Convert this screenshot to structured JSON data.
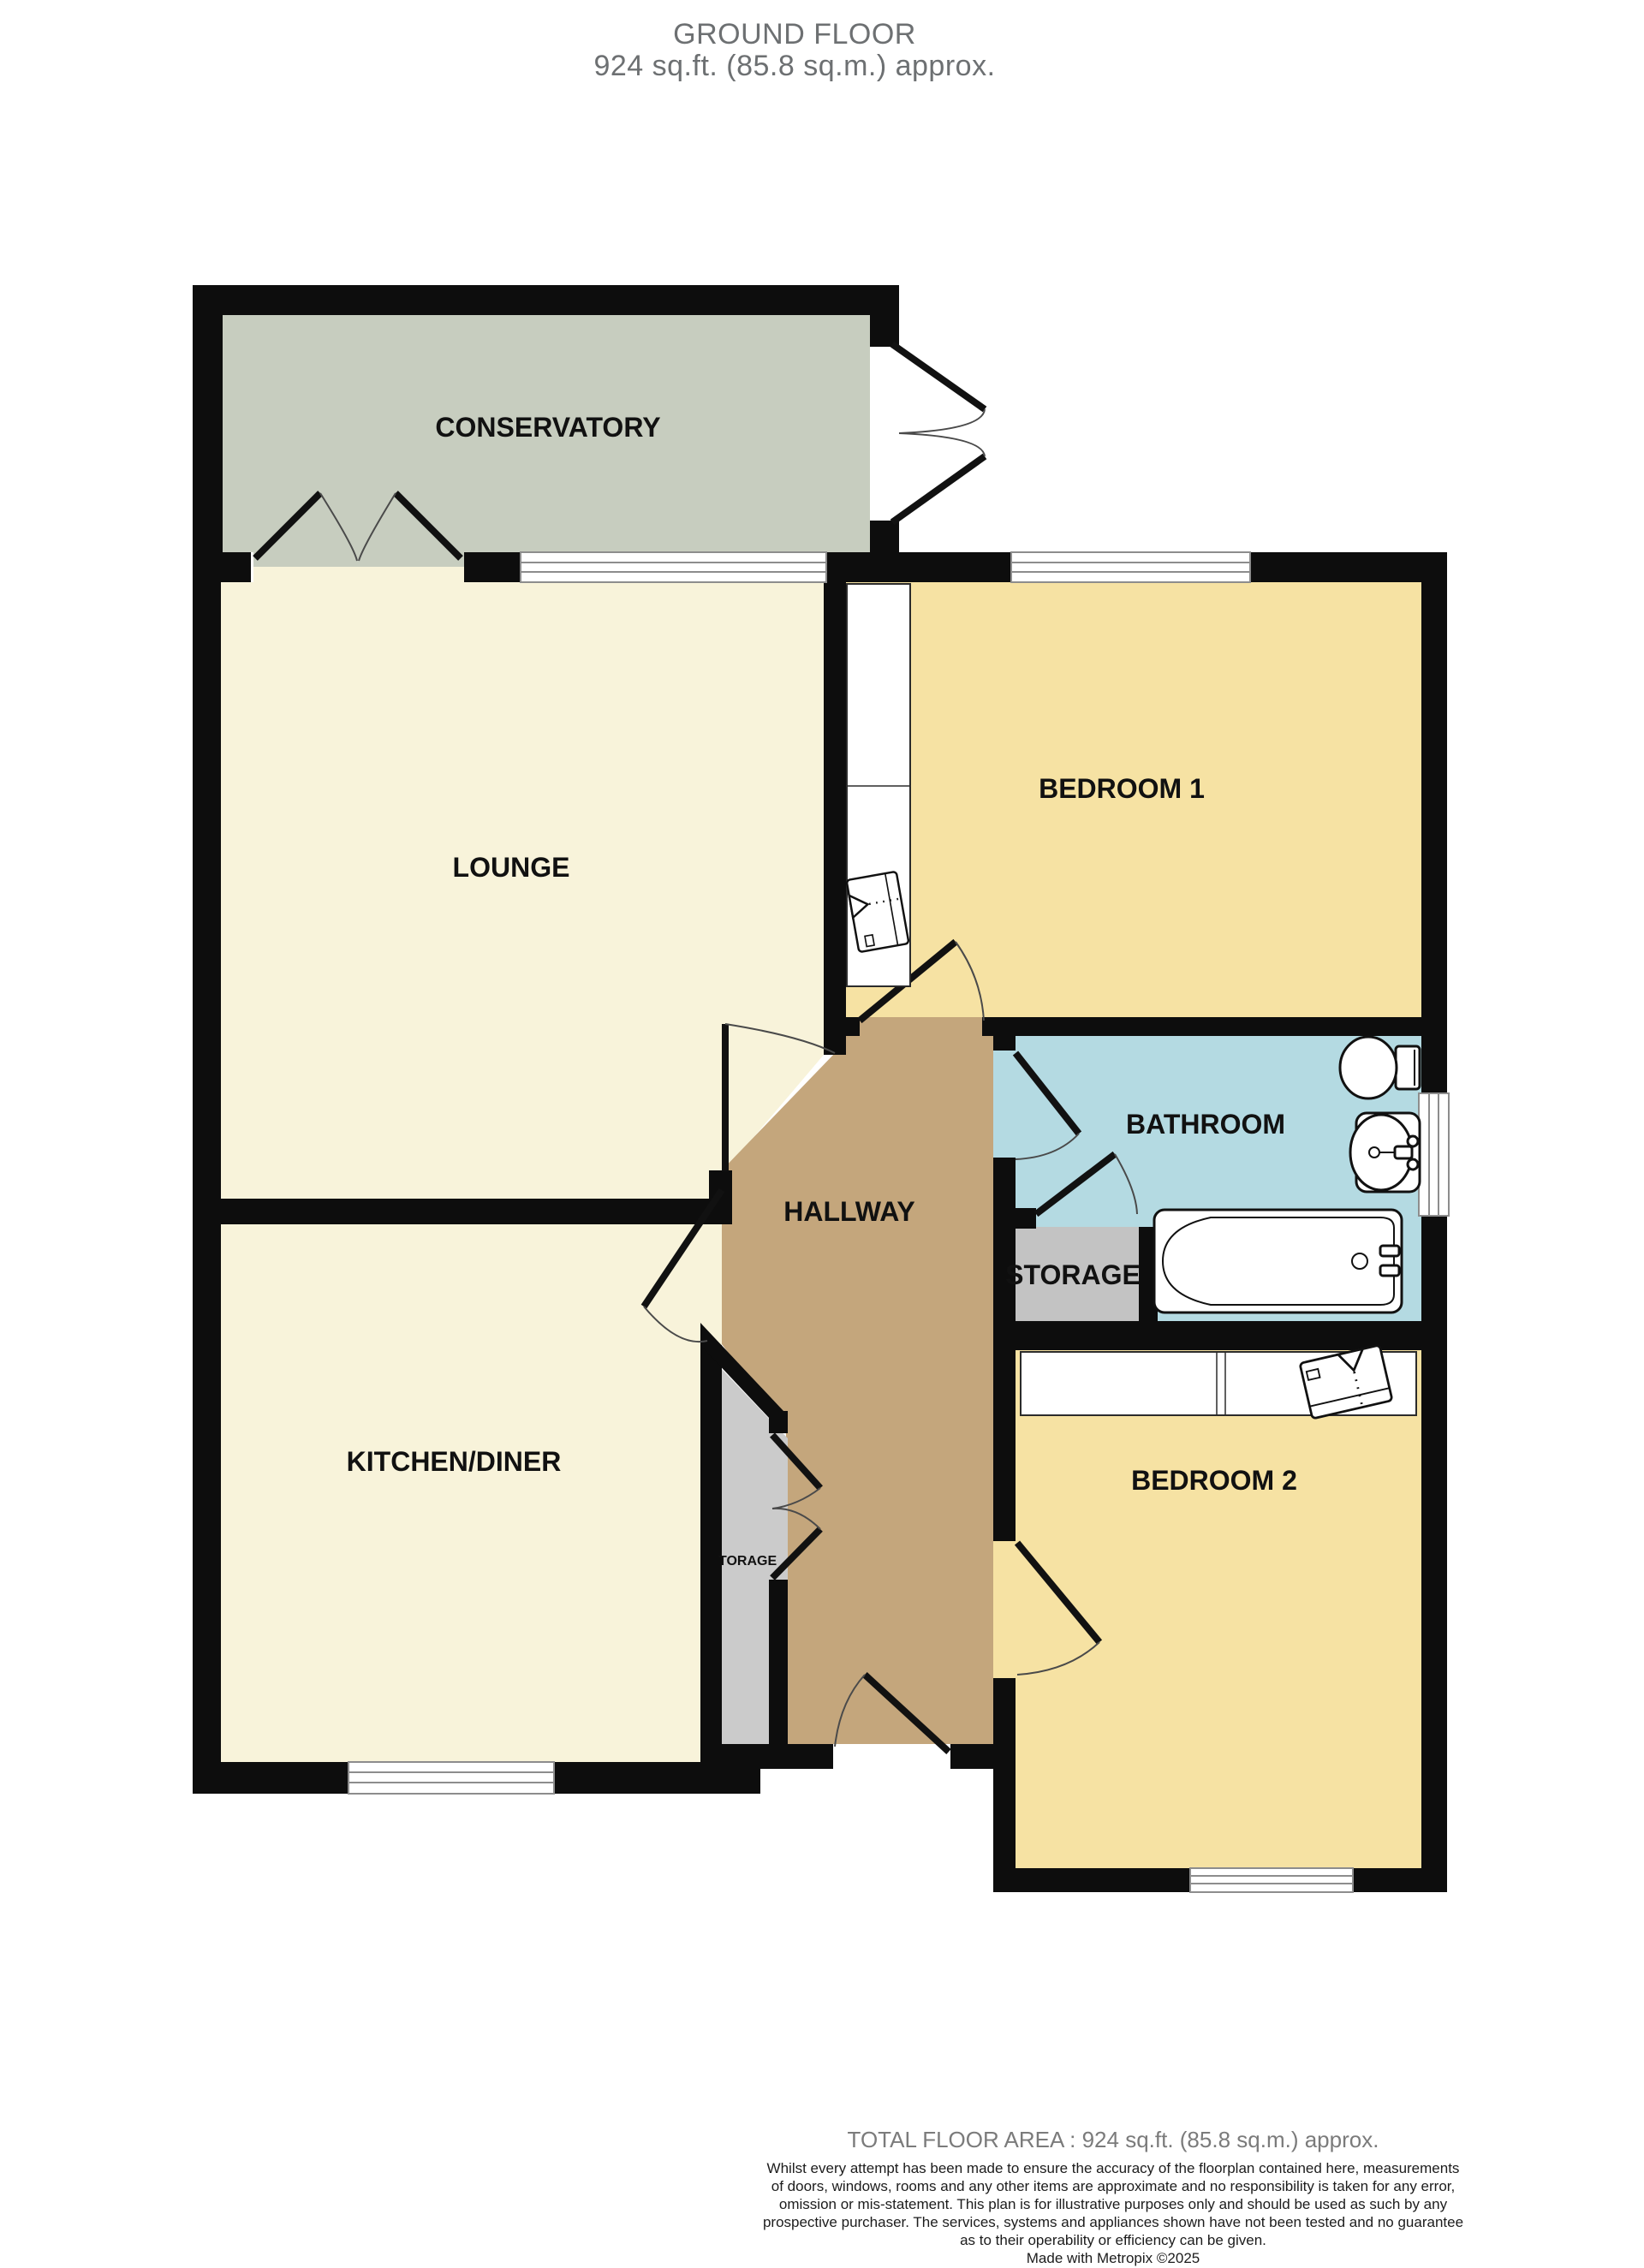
{
  "title": {
    "line1": "GROUND FLOOR",
    "line2": "924 sq.ft. (85.8 sq.m.) approx."
  },
  "rooms": {
    "conservatory": "CONSERVATORY",
    "lounge": "LOUNGE",
    "bedroom1": "BEDROOM 1",
    "bathroom": "BATHROOM",
    "storage": "STORAGE",
    "hallway": "HALLWAY",
    "kitchen": "KITCHEN/DINER",
    "bedroom2": "BEDROOM 2",
    "small_storage": "TORAGE"
  },
  "footer": {
    "total": "TOTAL FLOOR AREA : 924 sq.ft. (85.8 sq.m.) approx.",
    "disclaimer_lines": [
      "Whilst every attempt has been made to ensure the accuracy of the floorplan contained here, measurements",
      "of doors, windows, rooms and any other items are approximate and no responsibility is taken for any error,",
      "omission or mis-statement. This plan is for illustrative purposes only and should be used as such by any",
      "prospective purchaser. The services, systems and appliances shown have not been tested and no guarantee",
      "as to their operability or efficiency can be given."
    ],
    "credit": "Made with Metropix ©2025"
  },
  "palette": {
    "wall": "#0d0d0d",
    "conservatory": "#c7cdbf",
    "cream": "#f8f3da",
    "yellow": "#f6e2a3",
    "blue": "#b4dae2",
    "hallway": "#c4a67c",
    "storage_gray": "#c3c3c3",
    "closet_gray": "#cbcbcb",
    "title_gray": "#6d7072",
    "footer_gray": "#7b7b7b"
  }
}
